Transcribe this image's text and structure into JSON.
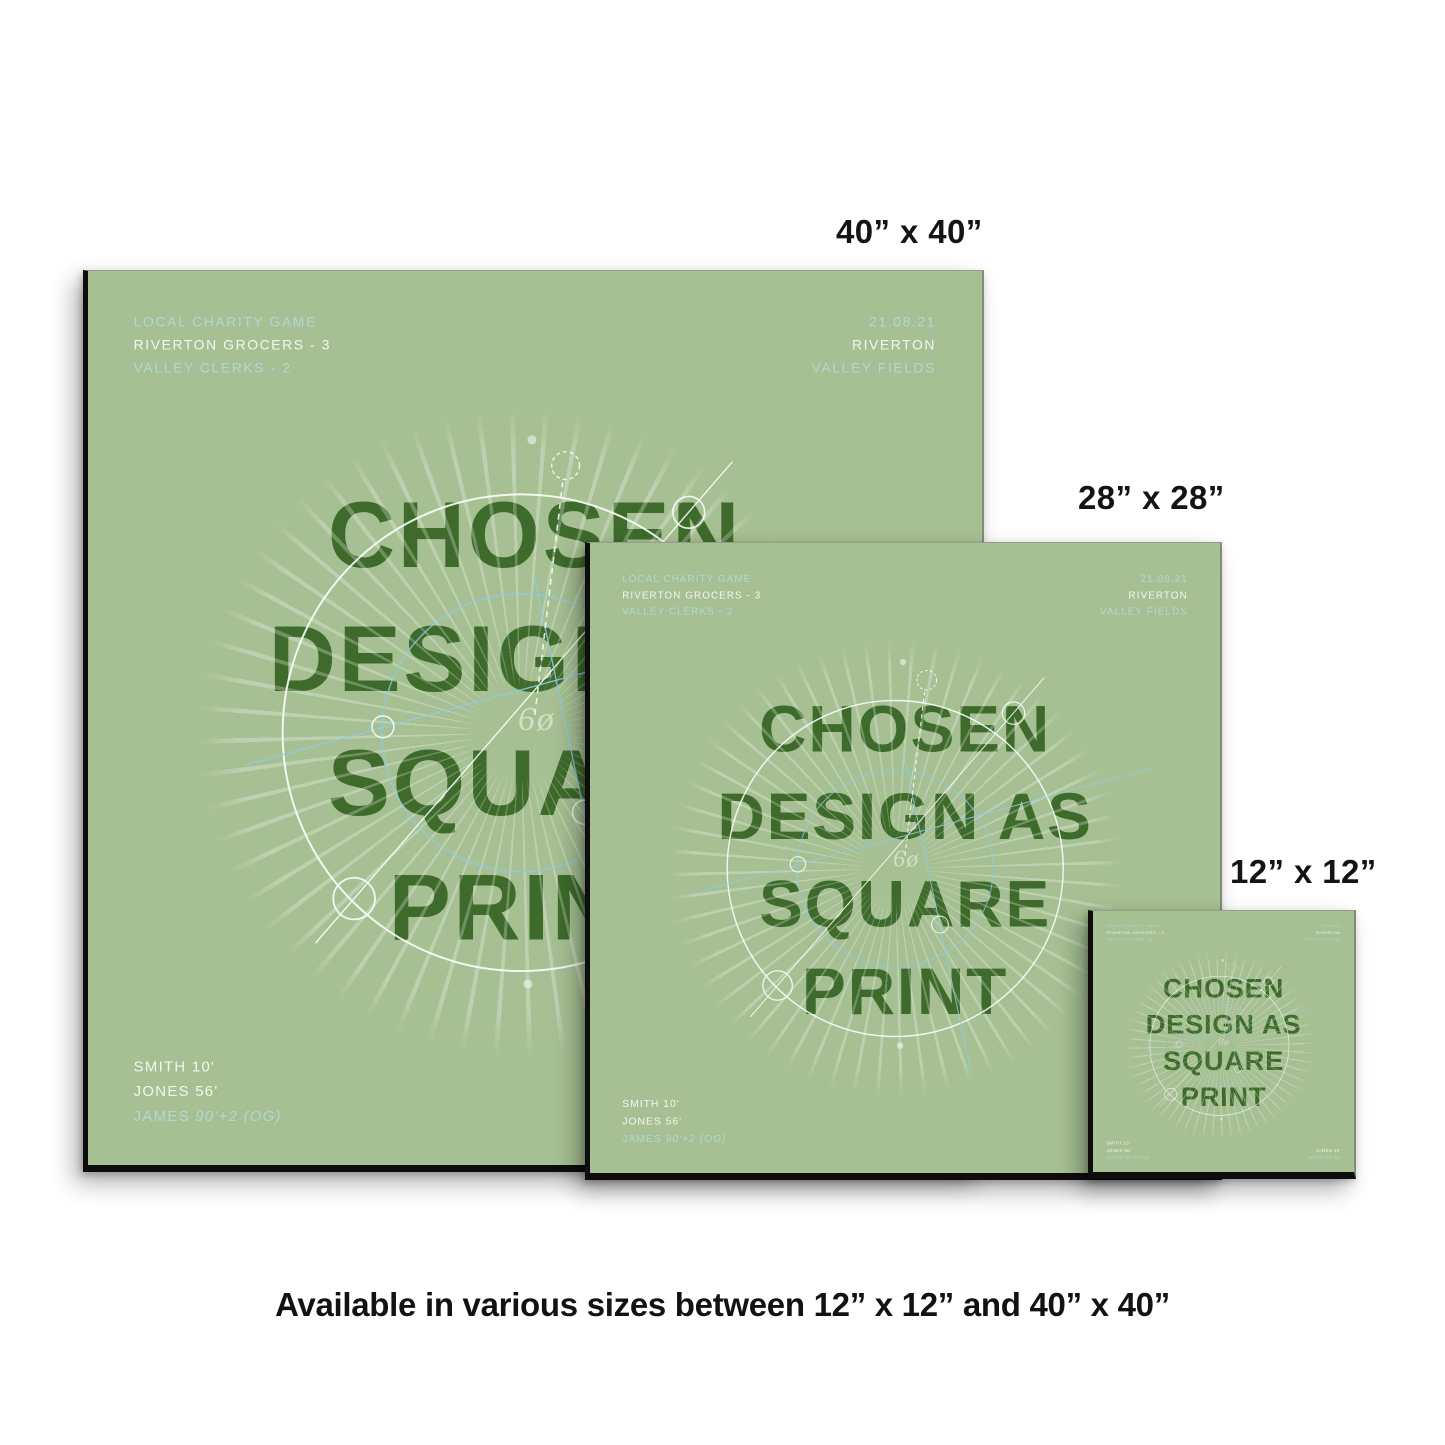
{
  "page": {
    "background": "#ffffff",
    "caption": "Available in various sizes between 12” x 12” and 40” x 40”"
  },
  "size_labels": {
    "large": "40” x 40”",
    "medium": "28” x 28”",
    "small": "12” x 12”"
  },
  "poster": {
    "colors": {
      "background": "#a6c093",
      "title_green": "#3e6b2b",
      "pale_blue": "#b3d7d6",
      "white": "#f2f6ee",
      "cyan_line": "#8ecbe8",
      "edge_black": "#0d0d0d"
    },
    "header_left": {
      "line1": "LOCAL CHARITY GAME",
      "line2": "RIVERTON GROCERS - 3",
      "line3": "VALLEY CLERKS - 2"
    },
    "header_right": {
      "line1": "21.08.21",
      "line2": "RIVERTON",
      "line3": "VALLEY FIELDS"
    },
    "title_lines": [
      "CHOSEN",
      "DESIGN AS",
      "SQUARE",
      "PRINT"
    ],
    "center_glyph": "6ø",
    "footer_left": {
      "line1": "SMITH 10'",
      "line2": "JONES 56'",
      "line3_name": "JAMES",
      "line3_detail": "90'+2 (OG)"
    },
    "footer_right": {
      "line1": "JAMES 40'",
      "line2": "WEBSTER 65'"
    }
  }
}
